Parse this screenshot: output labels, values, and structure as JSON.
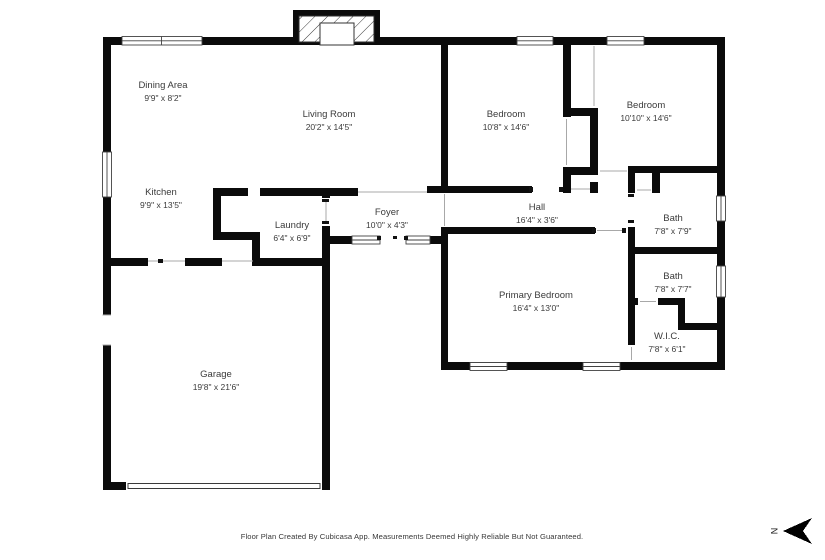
{
  "meta": {
    "footer": "Floor Plan Created By Cubicasa App. Measurements Deemed Highly Reliable But Not Guaranteed."
  },
  "compass": {
    "north_label": "N"
  },
  "colors": {
    "wall": "#0b0b0b",
    "label": "#3b3b3b",
    "window_stroke": "#424242",
    "opening_line": "#a8a8a8"
  },
  "rooms": {
    "dining": {
      "name": "Dining Area",
      "dims": "9'9\" x 8'2\""
    },
    "living": {
      "name": "Living Room",
      "dims": "20'2\" x 14'5\""
    },
    "bedroom1": {
      "name": "Bedroom",
      "dims": "10'8\" x 14'6\""
    },
    "bedroom2": {
      "name": "Bedroom",
      "dims": "10'10\" x 14'6\""
    },
    "kitchen": {
      "name": "Kitchen",
      "dims": "9'9\" x 13'5\""
    },
    "laundry": {
      "name": "Laundry",
      "dims": "6'4\" x 6'9\""
    },
    "foyer": {
      "name": "Foyer",
      "dims": "10'0\" x 4'3\""
    },
    "hall": {
      "name": "Hall",
      "dims": "16'4\" x 3'6\""
    },
    "bath1": {
      "name": "Bath",
      "dims": "7'8\" x 7'9\""
    },
    "bath2": {
      "name": "Bath",
      "dims": "7'8\" x 7'7\""
    },
    "primary": {
      "name": "Primary Bedroom",
      "dims": "16'4\" x 13'0\""
    },
    "wic": {
      "name": "W.I.C.",
      "dims": "7'8\" x 6'1\""
    },
    "garage": {
      "name": "Garage",
      "dims": "19'8\" x 21'6\""
    }
  }
}
